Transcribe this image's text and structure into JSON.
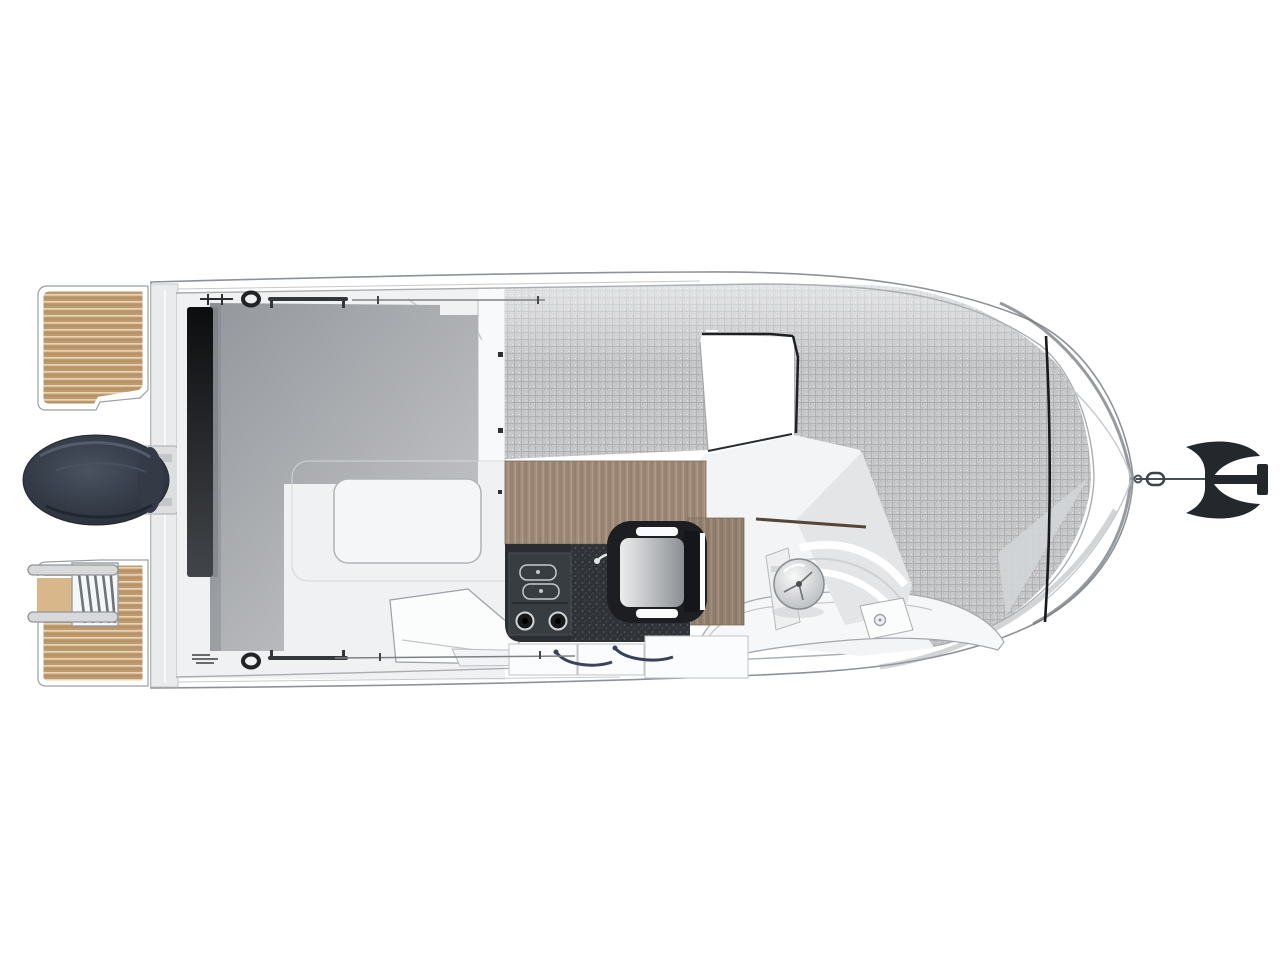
{
  "scene": {
    "type": "boat-deck-plan-top-view",
    "orientation": "bow-right"
  },
  "colors": {
    "page_bg": "#ffffff",
    "hull_fill": "#ffffff",
    "hull_outline": "#8d9298",
    "inner_line": "#a9aeb2",
    "deck_floor": "#f0f1f3",
    "transom_band": "#e9ebec",
    "teak_base": "#c09a6f",
    "teak_stripe": "#e6d4b6",
    "ladder_metal": "#d7d9db",
    "ladder_window": "#d8b88b",
    "motor_hi": "#4a5260",
    "motor_mid": "#353c48",
    "motor_dark": "#262c36",
    "roof_dark": "#94979c",
    "roof_light": "#c7c9cb",
    "door_bar_top": "#0c0d0f",
    "door_bar_bottom": "#424549",
    "sunpad_base": "#c6c7c9",
    "sunpad_line": "#a9abad",
    "wood_base": "#a08b79",
    "wood_dark": "#7f6d5d",
    "wood_light": "#bcab97",
    "galley_black": "#2a2d31",
    "stove_panel": "#383d42",
    "speckle_base": "#2f3337",
    "cushion_light": "#eceded",
    "cushion_dark": "#8b8f94",
    "seat_frame": "#1c1e21",
    "wheel_light": "#f7f8f8",
    "wheel_dark": "#b2b6ba",
    "anchor_dark": "#24272b",
    "chain_gray": "#4b4f53",
    "handle_blue": "#39425c",
    "fitting_dark": "#212326",
    "dash_trim_brown": "#554639",
    "bow_wedge": "#d2d5d7"
  },
  "parts": {
    "hull": "hull",
    "swim_platform_port": "swim-platform-port",
    "swim_platform_starboard": "swim-platform-starboard",
    "boarding_ladder": "boarding-ladder",
    "outboard_motor": "outboard-motor",
    "cockpit": "cockpit",
    "cockpit_hatch": "cockpit-floor-hatch",
    "roof_panel": "roof-panel",
    "sliding_door": "sliding-door",
    "galley_counter": "galley-counter",
    "stove": "stove",
    "helm_seat": "helm-seat",
    "helm_console": "helm-console",
    "steering_wheel": "steering-wheel",
    "bow_sunpad": "bow-sunpad",
    "anchor": "anchor"
  }
}
